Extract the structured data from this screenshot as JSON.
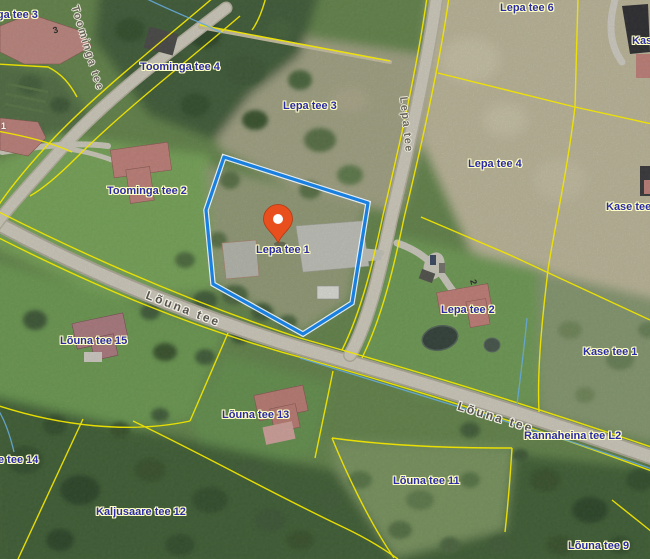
{
  "map": {
    "labels": {
      "toominga_tee_3": "Toominga tee 3",
      "toominga_tee_4": "Toominga tee 4",
      "lepa_tee_6": "Lepa tee 6",
      "kase_clipped": "Kase",
      "lepa_tee_3": "Lepa tee 3",
      "lepa_tee_4": "Lepa tee 4",
      "kase_tee_3": "Kase tee 3",
      "toominga_tee_2": "Toominga tee 2",
      "lepa_tee_1": "Lepa tee 1",
      "lepa_tee_2": "Lepa tee 2",
      "kase_tee_1": "Kase tee 1",
      "louna_tee_15": "Lõuna tee 15",
      "louna_tee_13": "Lõuna tee 13",
      "tee_14_clipped": "e tee 14",
      "kaljusaare_tee_12": "Kaljusaare tee 12",
      "louna_tee_11": "Lõuna tee 11",
      "rannaheina_tee_l2": "Rannaheina tee L2",
      "louna_tee_9": "Lõuna tee 9"
    },
    "road_labels": {
      "toominga_tee": "Toominga tee",
      "lepa_tee": "Lepa tee",
      "louna_tee": "Lõuna tee"
    },
    "roof_numbers": {
      "toominga_3": "3",
      "lepa_2": "2",
      "house_1": "1"
    },
    "marker": {
      "parcel": "Lepa tee 1",
      "color": "#E94E1D"
    },
    "colors": {
      "cadastral_line": "#F0E400",
      "highlight_parcel_line": "#1A80E0",
      "parcel_label_text": "#2B2BA8",
      "ditch_line": "#66A8D8"
    }
  }
}
